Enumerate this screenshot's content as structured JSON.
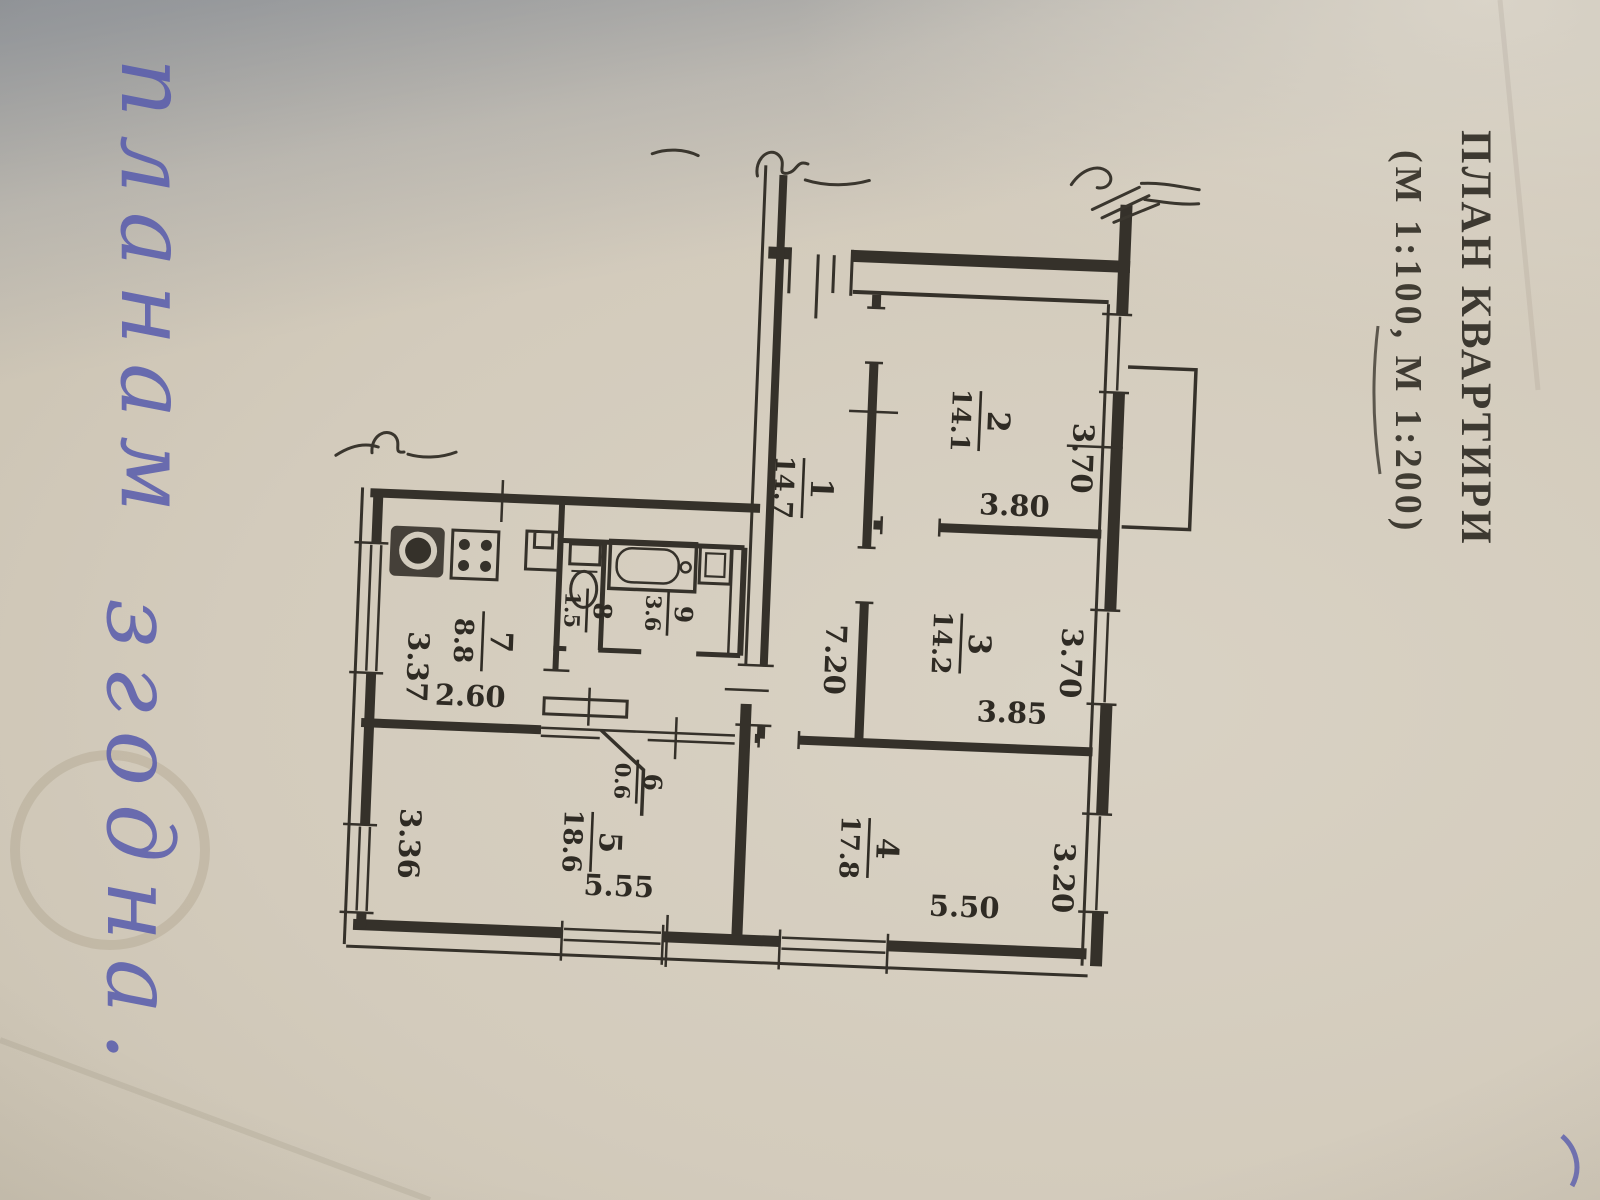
{
  "title": {
    "line1": "ПЛАН КВАРТИРИ",
    "line2": "(М 1:100, М 1:200)"
  },
  "handwriting": {
    "word1": "планам",
    "word2": "згодна."
  },
  "rooms": [
    {
      "number": "1",
      "area": "14.7"
    },
    {
      "number": "2",
      "area": "14.1"
    },
    {
      "number": "3",
      "area": "14.2"
    },
    {
      "number": "4",
      "area": "17.8"
    },
    {
      "number": "5",
      "area": "18.6"
    },
    {
      "number": "6",
      "area": "0.6"
    },
    {
      "number": "7",
      "area": "8.8"
    },
    {
      "number": "8",
      "area": "1.5"
    },
    {
      "number": "9",
      "area": "3.6"
    }
  ],
  "dimensions": [
    {
      "value": "3.80"
    },
    {
      "value": "3.70"
    },
    {
      "value": "3.85"
    },
    {
      "value": "3.70"
    },
    {
      "value": "5.50"
    },
    {
      "value": "3.20"
    },
    {
      "value": "5.55"
    },
    {
      "value": "3.36"
    },
    {
      "value": "2.60"
    },
    {
      "value": "3.37"
    },
    {
      "value": "7.20"
    }
  ],
  "colors": {
    "paper": "#d3ccbe",
    "ink": "#35312a",
    "blue_ink": "#575bad",
    "shadow": "#6c7078"
  }
}
